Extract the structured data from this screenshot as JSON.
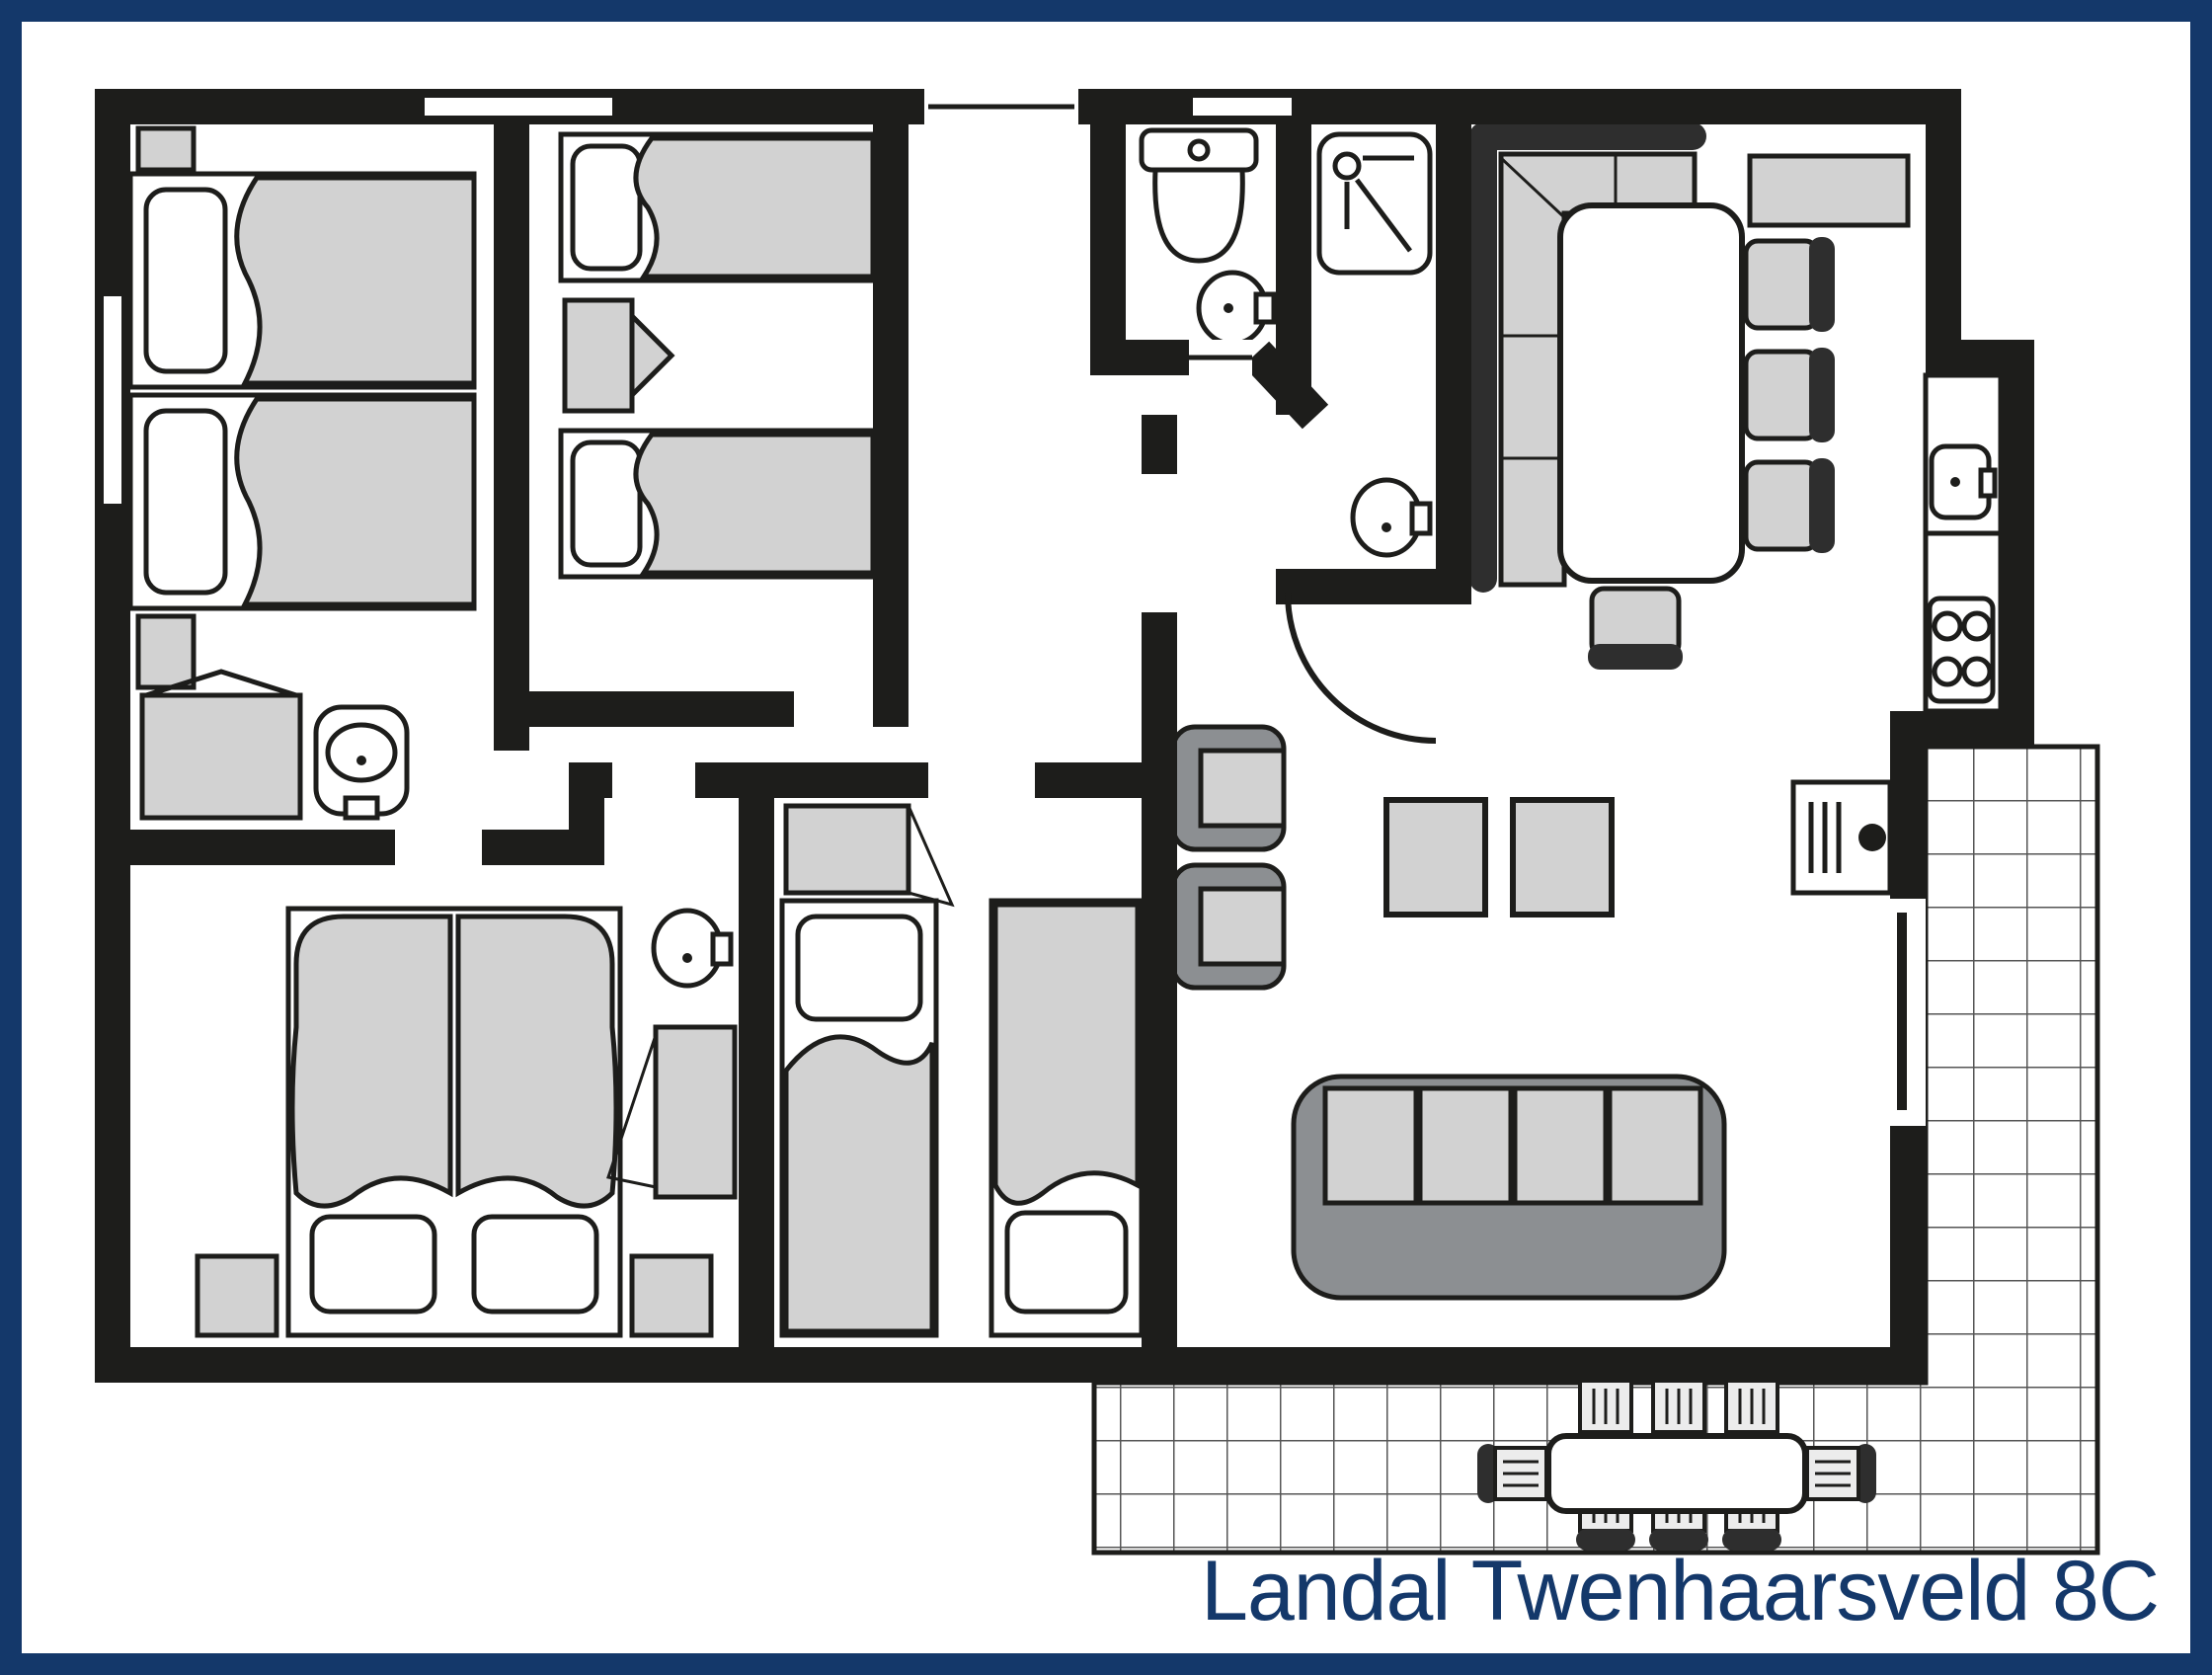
{
  "title": {
    "text": "Landal Twenhaarsveld 8C"
  },
  "colors": {
    "navy": "#14386a",
    "wall": "#1d1d1b",
    "furniture_light": "#d2d2d2",
    "furniture_mid": "#8c8f92",
    "furniture_dark": "#2e2e2e",
    "tile_line": "#555555",
    "paper": "#ffffff"
  },
  "floor_plan": {
    "type": "holiday-cottage-floor-plan",
    "rooms": [
      {
        "name": "bedroom-top-left",
        "fixtures": [
          "single-bed",
          "single-bed",
          "nightstand",
          "nightstand",
          "wardrobe",
          "washbasin"
        ]
      },
      {
        "name": "bedroom-top-middle",
        "fixtures": [
          "single-bed",
          "single-bed",
          "nightstand"
        ]
      },
      {
        "name": "wc",
        "fixtures": [
          "toilet",
          "washbasin"
        ]
      },
      {
        "name": "shower-room",
        "fixtures": [
          "shower-tray",
          "washbasin"
        ]
      },
      {
        "name": "hallway",
        "fixtures": [
          "entrance-door",
          "door-swing"
        ]
      },
      {
        "name": "living-dining-kitchen",
        "fixtures": [
          "corner-bench",
          "dining-table",
          "dining-chair",
          "dining-chair",
          "dining-chair",
          "dining-chair",
          "sideboard",
          "kitchen-counter",
          "kitchen-sink",
          "stove-4-burners",
          "tv",
          "armchair",
          "armchair",
          "coffee-table",
          "coffee-table",
          "sofa-4-seats",
          "terrace-sliding-door"
        ]
      },
      {
        "name": "bedroom-bottom-left",
        "fixtures": [
          "double-bed",
          "nightstand",
          "nightstand",
          "washbasin",
          "wardrobe"
        ]
      },
      {
        "name": "bedroom-bottom-middle",
        "fixtures": [
          "single-bed",
          "single-bed",
          "wardrobe"
        ]
      },
      {
        "name": "terrace",
        "fixtures": [
          "garden-table",
          "garden-chair",
          "garden-chair",
          "garden-chair",
          "garden-chair",
          "garden-chair",
          "garden-chair",
          "garden-chair",
          "garden-chair"
        ]
      }
    ]
  }
}
